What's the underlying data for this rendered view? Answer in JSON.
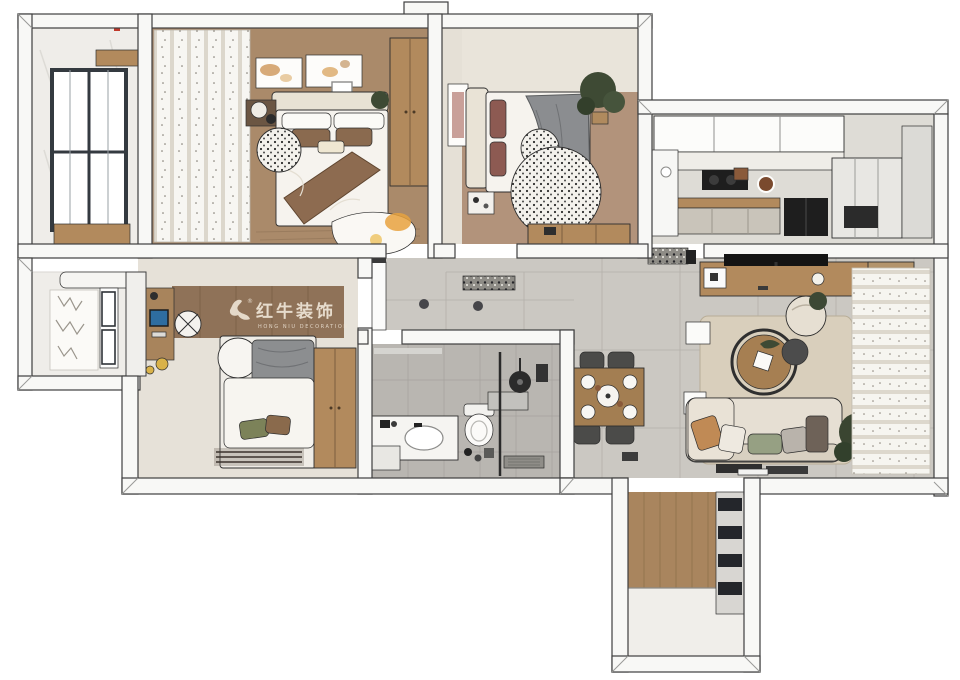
{
  "watermark": {
    "zh": "红牛装饰",
    "en": "HONG NIU DECORATION",
    "registered": "®"
  },
  "palette": {
    "wall": "#f8f8f6",
    "wall_outline": "#3f3f3f",
    "master_floor": "#aa8a6a",
    "bedroom2_floor": "#b2937b",
    "bedroom3_floor": "#e6e1d8",
    "accent_wall_wood": "#8f7258",
    "living_tile": "#cbc8c2",
    "kitchen_floor": "#dedcd6",
    "bath_tile": "#b9b6b1",
    "entry_wood": "#a9855e",
    "entry_tile": "#f0eeea",
    "balcony_floor": "#efede9",
    "wood_furniture": "#b28a5d",
    "bed_white": "#f6f3ee",
    "blanket_brown": "#8d6b50",
    "blanket_gray": "#8b8d90",
    "sofa_cream": "#e6dfd3",
    "rug_beige": "#d9cfbc",
    "plant_green": "#3e4a34",
    "appliance_black": "#1e1e1e",
    "accent_orange": "#e8a23e",
    "watermark_cream": "#eee4d6"
  }
}
